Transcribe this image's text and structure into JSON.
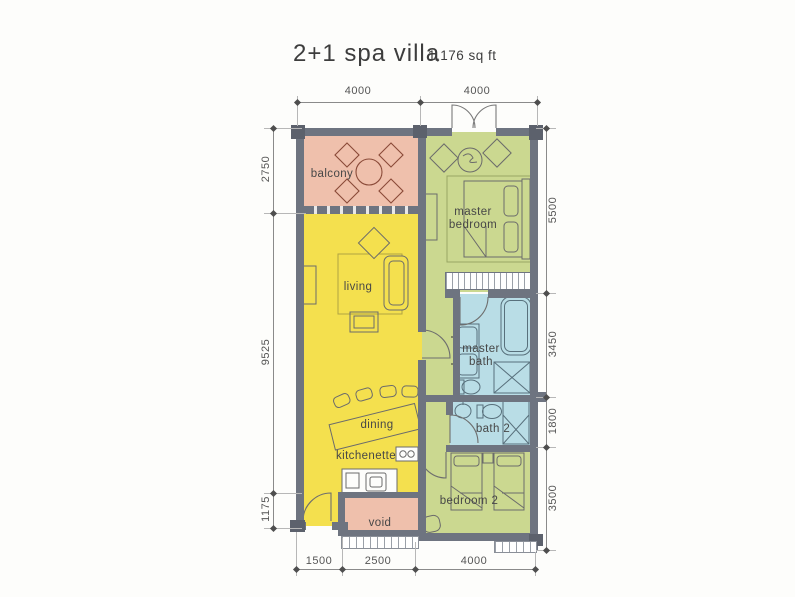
{
  "title": {
    "text": "2+1 spa villa",
    "area": "1,176 sq ft"
  },
  "rooms": {
    "balcony": "balcony",
    "master_bedroom": "master bedroom",
    "living": "living",
    "master_bath": "master bath",
    "dining": "dining",
    "kitchenette": "kitchenette",
    "bath2": "bath 2",
    "bedroom2": "bedroom 2",
    "void": "void"
  },
  "dimensions": {
    "top": [
      "4000",
      "4000"
    ],
    "left": [
      "2750",
      "9525",
      "1175"
    ],
    "right": [
      "5500",
      "3450",
      "1800",
      "3500"
    ],
    "bottom": [
      "1500",
      "2500",
      "4000"
    ]
  },
  "colors": {
    "floor_living": "#f4e04e",
    "floor_bedroom": "#cbd890",
    "floor_bath": "#b9dde6",
    "floor_balcony": "#efc0ac",
    "wall": "#6e7480"
  }
}
